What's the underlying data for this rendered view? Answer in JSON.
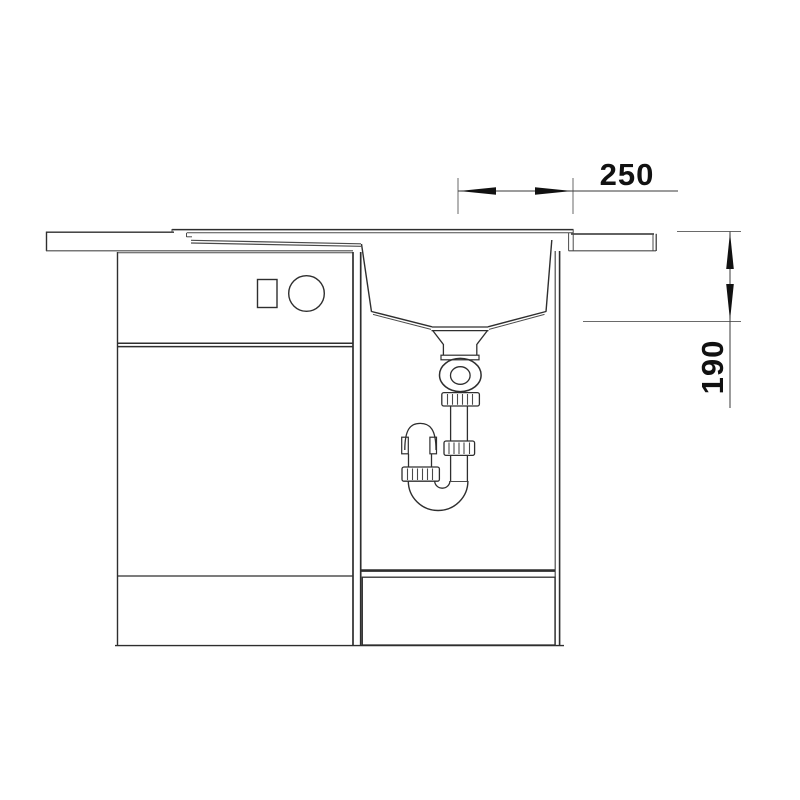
{
  "drawing": {
    "kind": "sink-cabinet-section-drawing",
    "dimensions": {
      "width": {
        "label": "250"
      },
      "depth": {
        "label": "190"
      }
    },
    "colors": {
      "background": "#ffffff",
      "line_dark": "#2e2e2e",
      "line_medium": "#4a4a4a",
      "line_light": "#6e6e6e",
      "text": "#111111"
    }
  }
}
